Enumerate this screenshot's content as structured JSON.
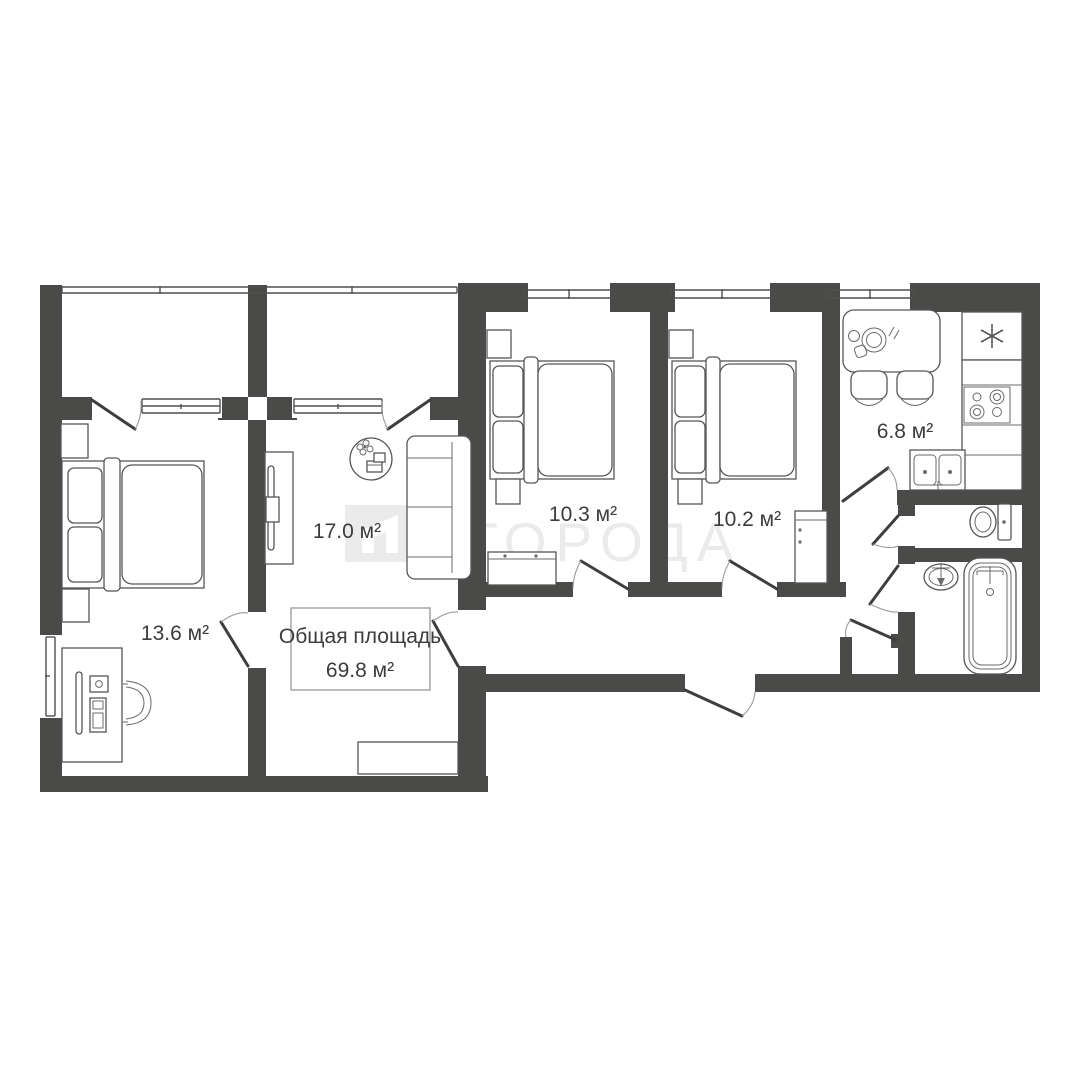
{
  "watermark": {
    "text": "ГОРОДА",
    "logo_icon": "goroda-logo",
    "color": "#ebebeb"
  },
  "total_area": {
    "line1": "Общая площадь",
    "line2": "69.8 м²"
  },
  "rooms": {
    "bedroom_left": {
      "label": "13.6 м²"
    },
    "living_room": {
      "label": "17.0 м²"
    },
    "bedroom_mid": {
      "label": "10.3 м²"
    },
    "bedroom_right": {
      "label": "10.2 м²"
    },
    "kitchen": {
      "label": "6.8 м²"
    }
  },
  "colors": {
    "wall": "#4a4a48",
    "furniture_stroke": "#565656",
    "text": "#3c3c3c",
    "watermark": "#ebebeb",
    "background": "#ffffff"
  }
}
